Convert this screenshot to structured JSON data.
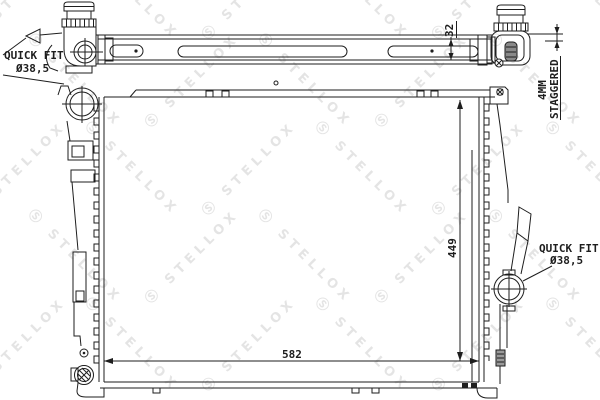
{
  "page": {
    "background": "#ffffff",
    "line_color": "#1e1e1e"
  },
  "watermark": {
    "logo": "Ⓢ",
    "brand": "STELLOX",
    "color": "#cfcfcf",
    "opacity": 0.55,
    "rows": 5,
    "cols": 6
  },
  "labels": {
    "quick_fit_left": {
      "line1": "QUICK FIT",
      "line2": "Ø38,5"
    },
    "quick_fit_right": {
      "line1": "QUICK FIT",
      "line2": "Ø38,5"
    },
    "dimensions": {
      "width": "582",
      "height": "449",
      "bar_height": "32",
      "stagger_line1": "4MM",
      "stagger_line2": "STAGGERED"
    }
  }
}
